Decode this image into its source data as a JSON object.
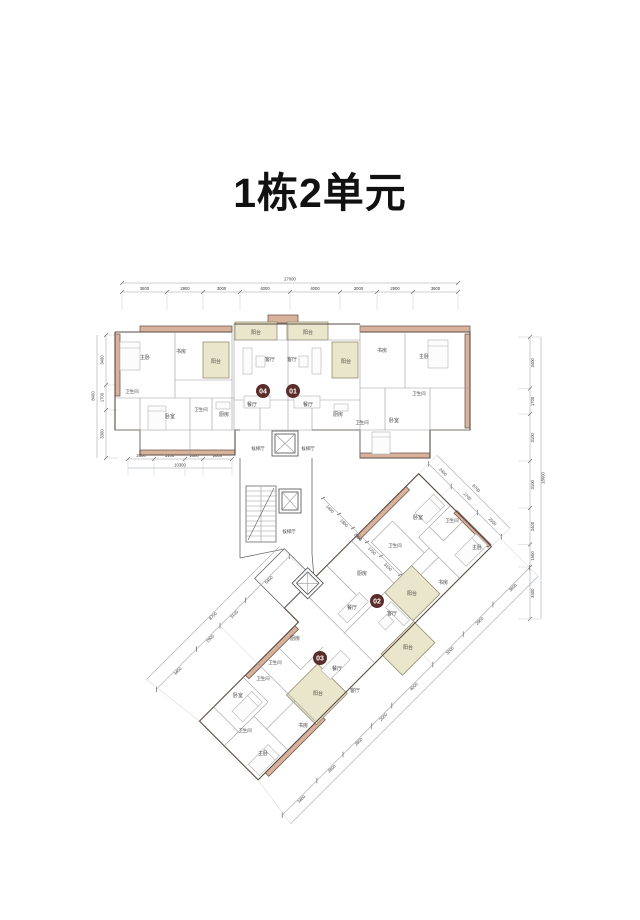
{
  "title": "1栋2单元",
  "units": {
    "u01": "01",
    "u02": "02",
    "u03": "03",
    "u04": "04"
  },
  "rooms": {
    "master": "主卧",
    "bedroom": "卧室",
    "study": "书房",
    "balcony": "阳台",
    "living": "客厅",
    "dining": "餐厅",
    "kitchen": "厨房",
    "bath": "卫生间",
    "lift_hall": "候梯厅"
  },
  "colors": {
    "wall_fill": "#d9b29b",
    "balcony_fill": "#eae6cb",
    "badge": "#5b2d2a",
    "dim_line": "#9aa0a5"
  },
  "dims": {
    "top": {
      "total": "27000",
      "segs": [
        "3600",
        "2900",
        "3000",
        "4000",
        "4000",
        "3000",
        "2900",
        "3600"
      ]
    },
    "left": {
      "total": "8400",
      "segs": [
        "3400",
        "1700",
        "3300"
      ]
    },
    "bottom_left": {
      "total": "10300",
      "segs": [
        "2600",
        "3100",
        "1800",
        "2800"
      ]
    },
    "right": {
      "total": "18600",
      "segs": [
        "3400",
        "1700",
        "3100",
        "3100",
        "2400",
        "1500",
        "3400"
      ]
    },
    "diag_ne": {
      "total": "8700",
      "segs": [
        "2500",
        "2700",
        "2400"
      ]
    },
    "diag_se": {
      "segs": [
        "3600",
        "2900",
        "3000",
        "4000",
        "2000",
        "2800",
        "2600",
        "3400"
      ]
    },
    "diag_nw": {
      "total": "8700",
      "segs": [
        "5400",
        "3100",
        "2900",
        "3400"
      ]
    },
    "diag_corridor": {
      "segs": [
        "1400",
        "1800",
        "2000",
        "1700",
        "3100"
      ]
    }
  }
}
